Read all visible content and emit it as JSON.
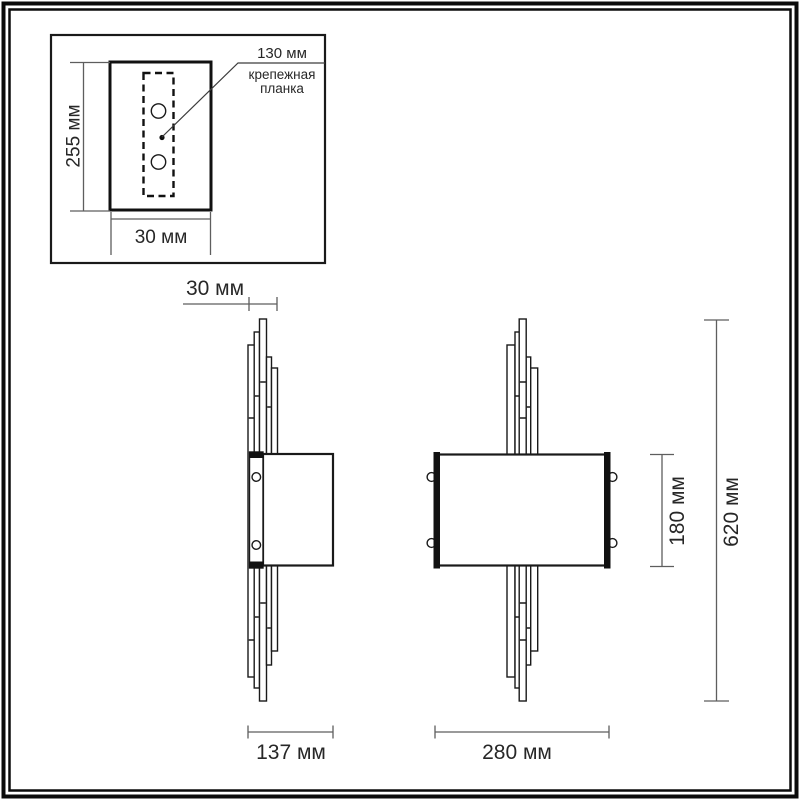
{
  "diagram": {
    "kind": "wall-sconce dimension drawing",
    "inset": {
      "plate_height": "255 мм",
      "plate_width": "30 мм",
      "callout_value": "130 мм",
      "callout_name_line1": "крепежная",
      "callout_name_line2": "планка"
    },
    "side_view": {
      "depth": "30 мм",
      "width": "137 мм"
    },
    "front_view": {
      "shade_height": "180 мм",
      "total_height": "620 мм",
      "width": "280 мм"
    },
    "colors": {
      "line": "#1a1a1a",
      "dimension_line": "#5e5e5e",
      "text": "#272727",
      "background": "#ffffff"
    }
  }
}
